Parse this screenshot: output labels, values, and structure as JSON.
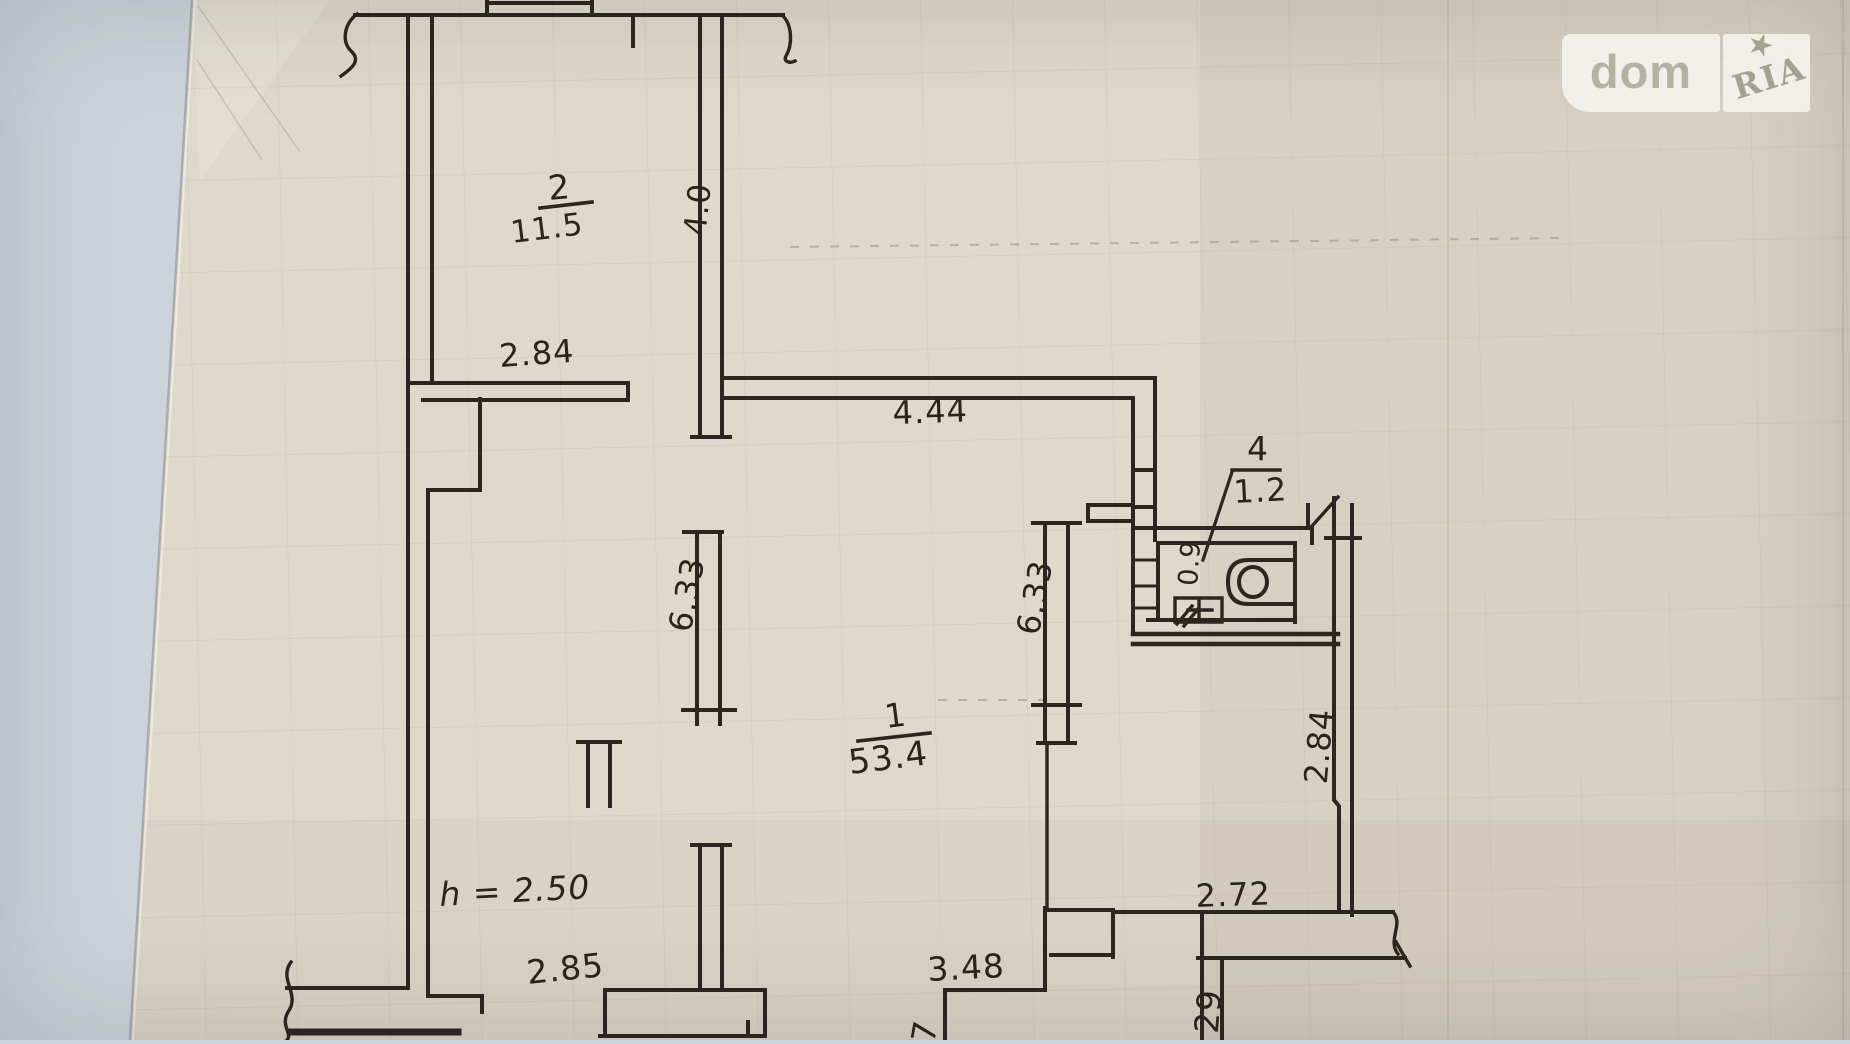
{
  "watermark": {
    "brand_left": "dom",
    "brand_right": "RIA"
  },
  "plan": {
    "rooms": [
      {
        "number": "2",
        "area": "11.5"
      },
      {
        "number": "1",
        "area": "53.4"
      },
      {
        "number": "4",
        "area": "1.2"
      }
    ],
    "labels": {
      "room2_number": "2",
      "room2_area": "11.5",
      "room1_number": "1",
      "room1_area": "53.4",
      "room4_number": "4",
      "room4_area": "1.2",
      "dim_room2_width": "2.84",
      "dim_room2_depth": "4.0",
      "dim_hall_width": "4.44",
      "dim_pier_left": "6.33",
      "dim_pier_right": "6.33",
      "dim_wc_width": "0.9",
      "dim_right_wall": "2.84",
      "dim_bottom_right": "2.72",
      "dim_opening_left": "2.85",
      "dim_opening_right": "3.48",
      "dim_cut_bottom_left": "7",
      "dim_cut_bottom_right": "29",
      "ceiling_height": "h = 2.50"
    }
  },
  "colors": {
    "background": "#ccd3da",
    "paper": "#ded9cb",
    "ink": "#2b261f",
    "grid_line": "#96825f",
    "watermark_text": "#aba698"
  }
}
